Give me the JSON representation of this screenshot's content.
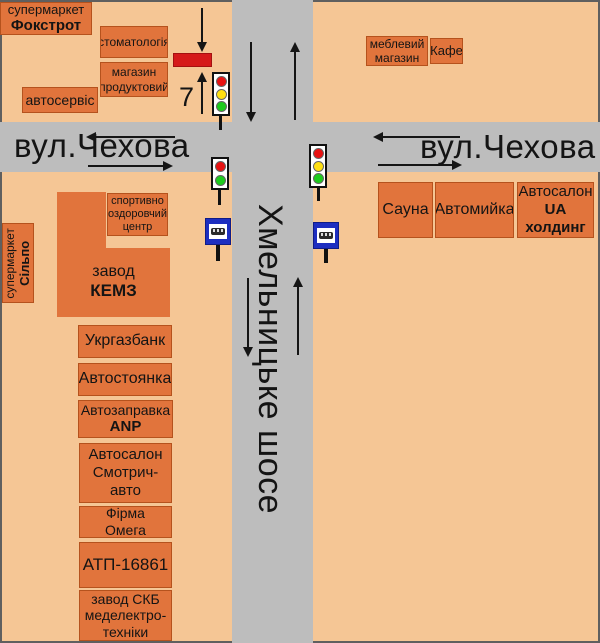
{
  "streets": {
    "chekhova_left": "вул.Чехова",
    "chekhova_right": "вул.Чехова",
    "khmelnytske": "Хмельницьке шосе"
  },
  "billboard": {
    "number": "7",
    "marker_color": "#d51a1a"
  },
  "colors": {
    "background": "#f5c695",
    "road": "#bdbdbd",
    "box_fill": "#e1743c",
    "box_border": "#b5521d",
    "traffic_red": "#e81313",
    "traffic_yellow": "#ffe012",
    "traffic_green": "#1ecb1e",
    "bus_sign_blue": "#1d2ec0"
  },
  "places": {
    "fokstrot": {
      "line1": "супермаркет",
      "line2": "Фокстрот"
    },
    "dentistry": {
      "label": "стоматологія"
    },
    "grocery": {
      "label": "магазин\nпродуктовий"
    },
    "autoservice": {
      "label": "автосервіс"
    },
    "furniture": {
      "label": "меблевий\nмагазин"
    },
    "cafe": {
      "label": "Кафе"
    },
    "sport_center": {
      "label": "спортивно\nоздоровчий\nцентр"
    },
    "kemz": {
      "line1": "завод",
      "line2": "КЕМЗ"
    },
    "silpo": {
      "line1": "супермаркет",
      "line2": "Сільпо"
    },
    "ukrgazbank": {
      "label": "Укргазбанк"
    },
    "parking": {
      "label": "Автостоянка"
    },
    "gas_station": {
      "line1": "Автозаправка",
      "line2": "ANP"
    },
    "smotrych": {
      "label": "Автосалон\nСмотрич-\nавто"
    },
    "omega": {
      "label": "Фірма\nОмега"
    },
    "atp": {
      "label": "АТП-16861"
    },
    "skb": {
      "label": "завод СКБ\nмеделектро-\nтехніки"
    },
    "sauna": {
      "label": "Сауна"
    },
    "carwash": {
      "label": "Автомийка"
    },
    "ua_holding": {
      "line1": "Автосалон",
      "line2": "UA холдинг"
    }
  }
}
